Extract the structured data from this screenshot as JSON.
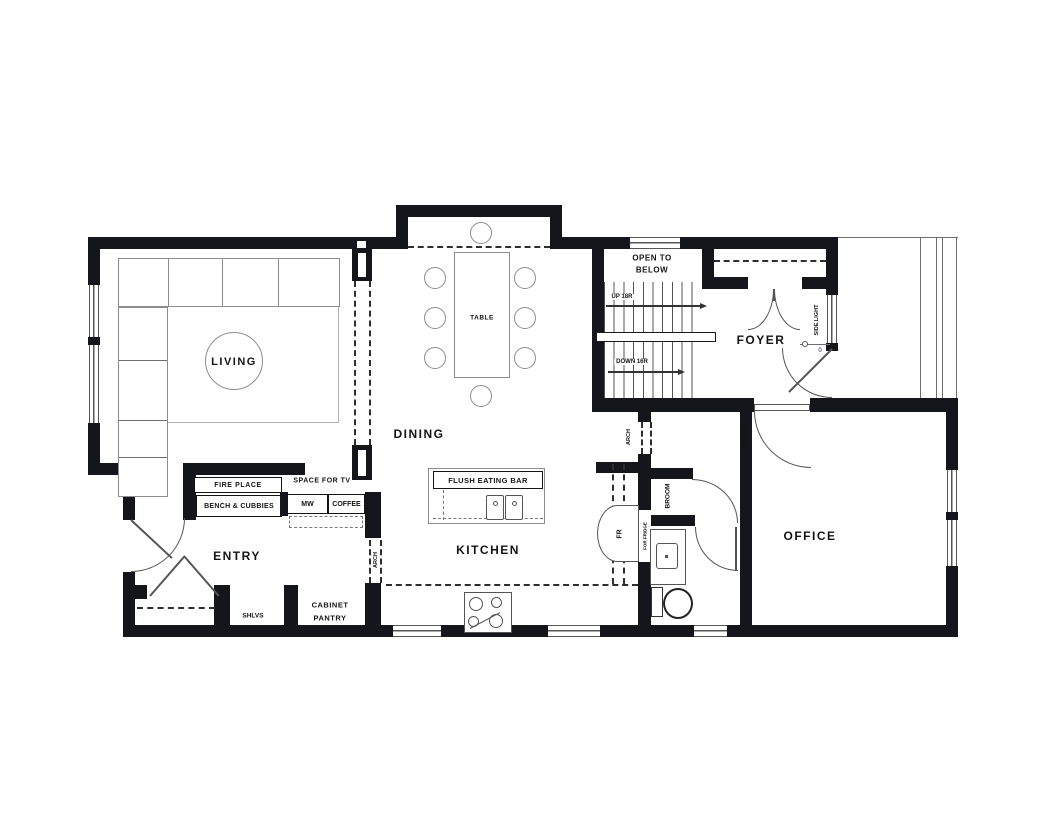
{
  "rooms": {
    "living": "LIVING",
    "dining": "DINING",
    "kitchen": "KITCHEN",
    "entry": "ENTRY",
    "foyer": "FOYER",
    "office": "OFFICE"
  },
  "stairs": {
    "open_to_below_line1": "OPEN TO",
    "open_to_below_line2": "BELOW",
    "up_label": "UP 18R",
    "down_label": "DOWN 16R"
  },
  "dining_area": {
    "table": "TABLE"
  },
  "kitchen_area": {
    "eating_bar": "FLUSH EATING BAR",
    "microwave": "MW",
    "coffee": "COFFEE",
    "fridge": "FR",
    "fridge_note": "FOR FRIDGE",
    "pantry_line1": "CABINET",
    "pantry_line2": "PANTRY"
  },
  "living_area": {
    "fireplace": "FIRE PLACE",
    "bench": "BENCH & CUBBIES",
    "tv": "SPACE FOR TV"
  },
  "entry_area": {
    "shelves": "SHLVS"
  },
  "closets": {
    "broom": "BROOM"
  },
  "annotations": {
    "arch": "ARCH",
    "french": "- FRENCH",
    "side_light": "SIDE LIGHT",
    "door_mark": "0"
  }
}
